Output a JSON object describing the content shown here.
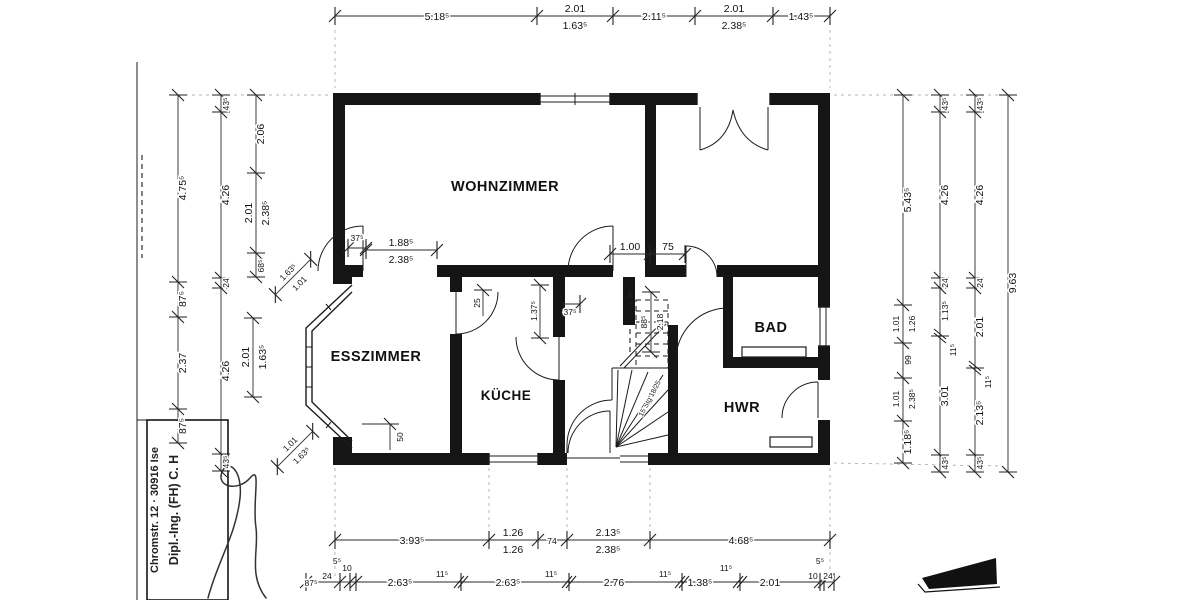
{
  "rooms": {
    "wohnzimmer": "WOHNZIMMER",
    "esszimmer": "ESSZIMMER",
    "kueche": "KÜCHE",
    "bad": "BAD",
    "hwr": "HWR"
  },
  "title_block": {
    "line1": "Dipl.-Ing. (FH) C. H",
    "line2": "Chromstr. 12 · 30916 Ise"
  },
  "dims": {
    "top": [
      "5.18⁵",
      "2.01",
      "1.63⁵",
      "2.11⁵",
      "2.01",
      "2.38⁵",
      "1.43⁵"
    ],
    "left_outer": [
      "4.75⁵",
      "87⁵",
      "2.37",
      "87⁵"
    ],
    "left_mid": [
      "43⁵",
      "4.26",
      "24",
      "4.26",
      "43⁵"
    ],
    "left_inner": [
      "2.06",
      "2.01",
      "2.38⁵",
      "68⁵",
      "1.63⁵",
      "1.01",
      "2.01",
      "1.63⁵",
      "1.01",
      "1.63⁵"
    ],
    "right_inner": [
      "5.43⁵",
      "1.01",
      "1.26",
      "99",
      "1.01",
      "2.38⁵",
      "1.18⁵"
    ],
    "right_mid": [
      "43⁵",
      "4.26",
      "24",
      "1.13⁵",
      "11⁵",
      "3.01",
      "43⁵"
    ],
    "right_outer": [
      "43⁵",
      "4.26",
      "24",
      "2.01",
      "11⁵",
      "2.13⁵",
      "43⁵"
    ],
    "right_total": "9.63",
    "bottom_upper": [
      "3.93⁵",
      "1.26",
      "1.26",
      "74",
      "2.13⁵",
      "2.38⁵",
      "4.68⁵"
    ],
    "bottom_lower": [
      "87⁵",
      "24",
      "5⁵",
      "10",
      "2.63⁵",
      "11⁵",
      "2.63⁵",
      "11⁵",
      "2.76",
      "11⁵",
      "1.38⁵",
      "11⁵",
      "2.01",
      "10",
      "24",
      "5⁵"
    ],
    "interior": {
      "door_wz": "37⁵",
      "opening_a": "1.88⁵",
      "opening_b": "2.38⁵",
      "hall_a": "1.00",
      "hall_b": "75",
      "bad_a": "88⁵",
      "bad_b": "2.18",
      "kitchen_jamb": "25",
      "kitchen_wall": "1.37⁵",
      "kitchen_door": "37⁵",
      "ess_wall": "50",
      "stairs": "15 Stg 18/25"
    }
  }
}
